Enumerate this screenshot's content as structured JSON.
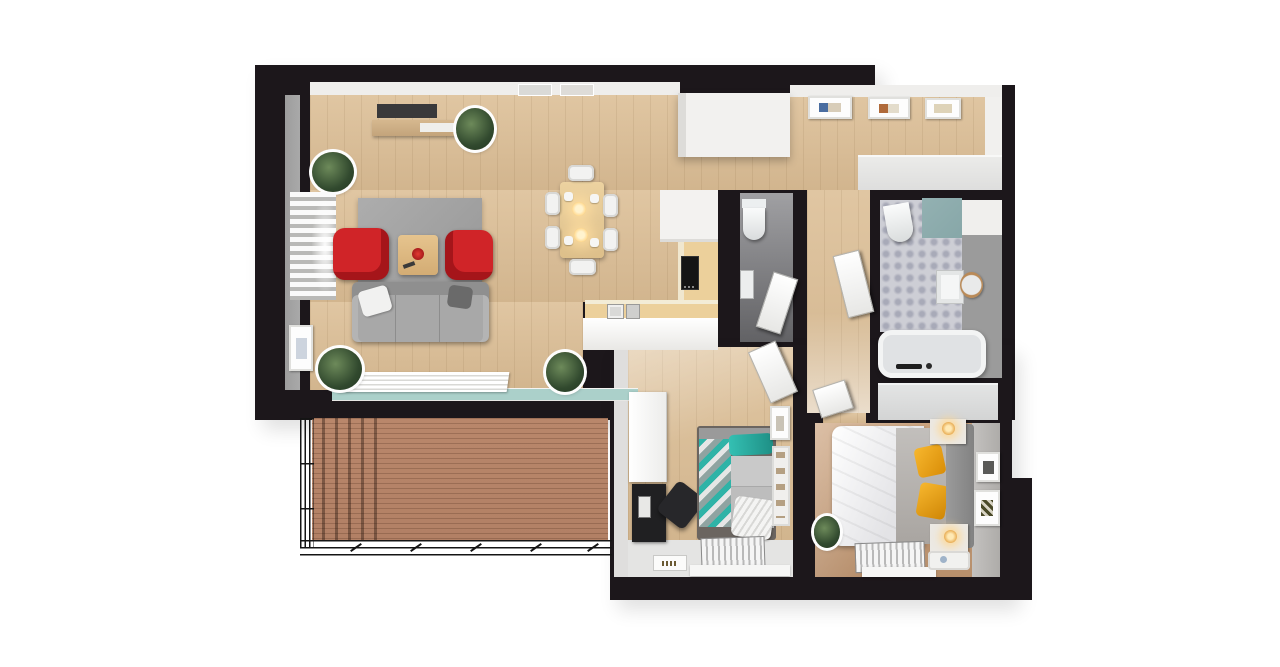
{
  "title": "Apartment floor plan — 3D top-down render",
  "palette": {
    "bg": "#ffffff",
    "wall": "#1c171b",
    "wall-face": "#efeeec",
    "wall-face-gray": "#a9a9a9",
    "floor-wood-1": "#e0c6a2",
    "floor-wood-2": "#d2b58e",
    "floor-master-1": "#cca480",
    "floor-master-2": "#b78f6c",
    "floor-light": "#e4e4e3",
    "deck": "#b28065",
    "glass": "#abd0ca",
    "rug": "#a2a2a2",
    "sofa": "#a8a8a8",
    "armchair-red": "#d02428",
    "table-wood": "#e7cb96",
    "counter-white": "#f3f2f0",
    "counter-wood": "#ecd09b",
    "cooktop": "#141414",
    "tile-base": "#cdced5",
    "tile-motif": "#a8aab8",
    "teal-panel": "#87a7a8",
    "bed-teal": "#2fb3a7",
    "duvet-white": "#f4f4f5",
    "blanket-gray": "#b7b4b1",
    "pillow-yellow": "#f3a815",
    "desk-black": "#202022",
    "radiator-1": "#f5f5f5",
    "radiator-2": "#b9b9b9",
    "plant-1": "#6d8a5a",
    "plant-2": "#31492e",
    "door-white": "#f7f7f6",
    "lamp-warm": "#ffd98f"
  },
  "rooms": {
    "living": {
      "name": "Open living room with dining area and kitchen",
      "furniture": [
        "gray sofa with cushions",
        "two red armchairs",
        "wooden coffee table with red bowl",
        "gray rug",
        "TV wall unit with console",
        "six-seat dining table with pendant lights",
        "L-shaped kitchen counter with cooktop",
        "tall white kitchen unit",
        "window with blinds and radiator",
        "potted plants"
      ]
    },
    "balcony": {
      "name": "Balcony with wooden decking and metal railing",
      "furniture": [
        "wood deck",
        "black metal railing",
        "sliding glass door strip"
      ]
    },
    "entry": {
      "name": "Entrance hall",
      "furniture": [
        "three framed pictures",
        "long white cabinet"
      ]
    },
    "wc": {
      "name": "Guest WC",
      "furniture": [
        "toilet",
        "wall-hung washbasin",
        "open white door"
      ]
    },
    "bathroom": {
      "name": "Bathroom with patterned tile floor",
      "furniture": [
        "bathtub with black faucet",
        "toilet",
        "washbasin with round wooden mirror",
        "teal accent wall"
      ]
    },
    "corridor": {
      "name": "Corridor",
      "furniture": [
        "white interior doors"
      ]
    },
    "bedroom_kids": {
      "name": "Bedroom with single bed and desk",
      "furniture": [
        "single bed with teal chevron bedding",
        "black desk and chair",
        "white wardrobe",
        "wall shelves",
        "radiator below window",
        "floor mat"
      ]
    },
    "bedroom_master": {
      "name": "Master bedroom",
      "furniture": [
        "double bed with white duvet and yellow pillows",
        "two nightstands with lamps",
        "wardrobe",
        "framed pictures",
        "radiator below window",
        "serving tray",
        "potted plant"
      ]
    }
  }
}
